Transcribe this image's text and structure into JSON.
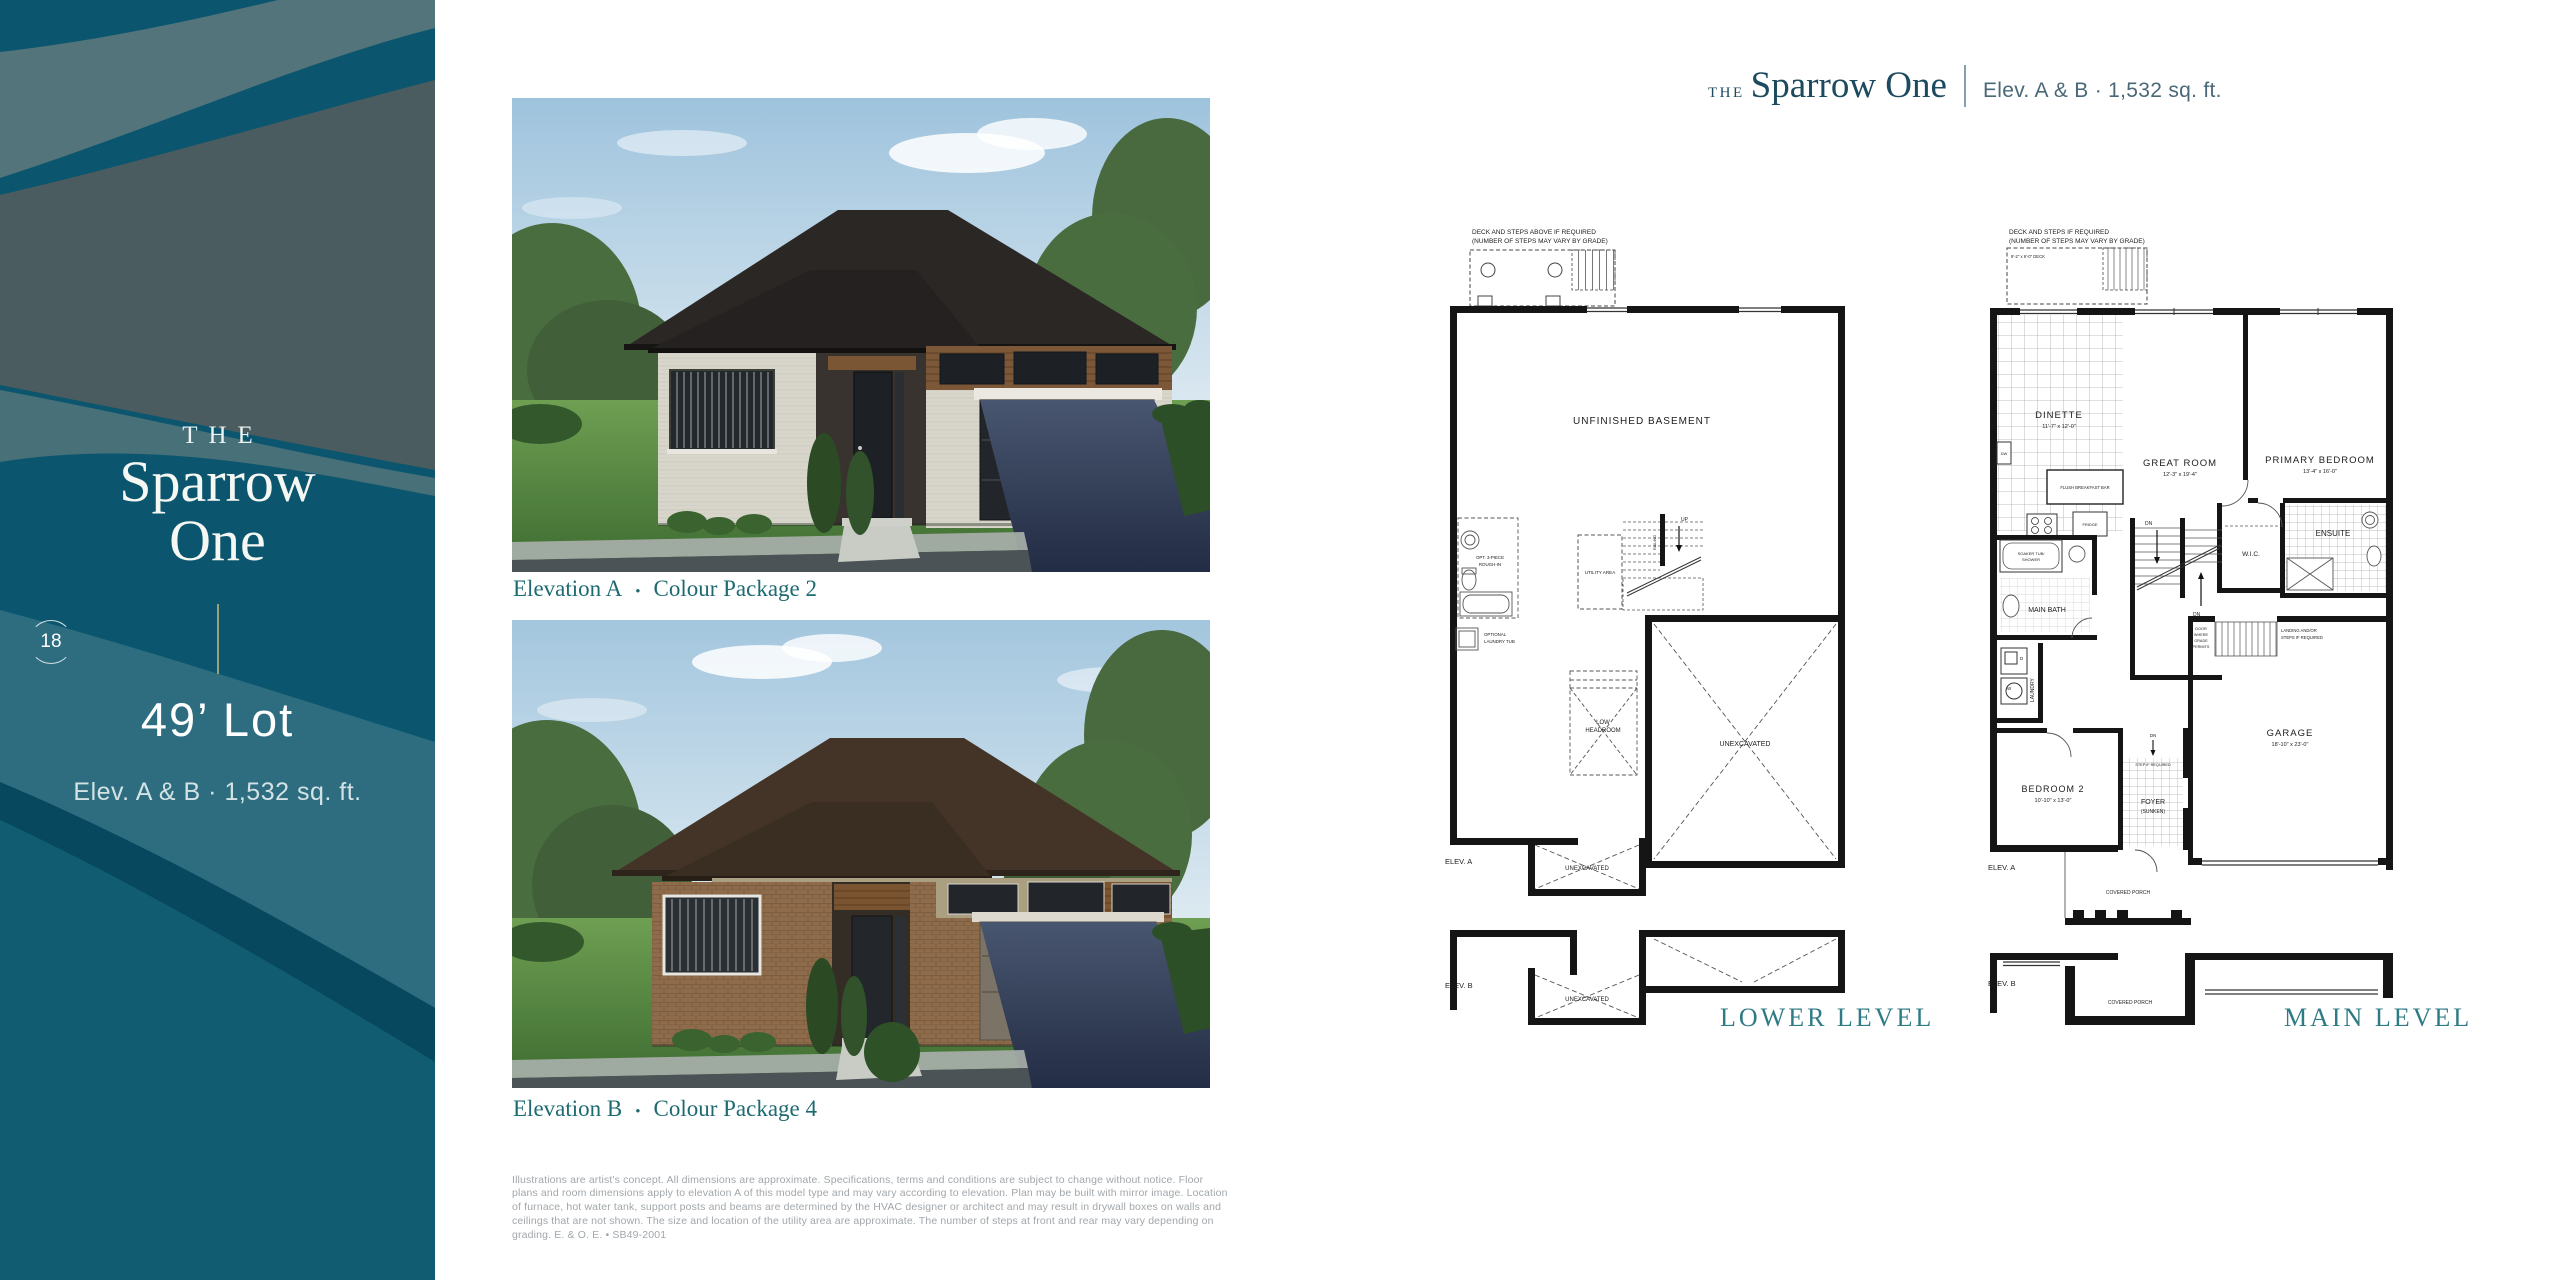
{
  "sidebar": {
    "eyebrow": "THE",
    "model_line1": "Sparrow",
    "model_line2": "One",
    "page_number": "18",
    "lot": "49’ Lot",
    "spec": "Elev. A & B · 1,532 sq. ft."
  },
  "header": {
    "eyebrow": "THE",
    "model_name": "Sparrow One",
    "spec": "Elev. A & B · 1,532 sq. ft."
  },
  "figures": {
    "a": {
      "name": "Elevation A",
      "bullet": "•",
      "package": "Colour Package 2"
    },
    "b": {
      "name": "Elevation B",
      "bullet": "•",
      "package": "Colour Package 4"
    }
  },
  "disclaimer": "Illustrations are artist's concept. All dimensions are approximate. Specifications, terms and conditions are subject to change without notice. Floor plans and room dimensions apply to elevation A of this model type and may vary according to elevation. Plan may be built with mirror image. Location of furnace, hot water tank, support posts and beams are determined by the HVAC designer or architect and may result in drywall boxes on walls and ceilings that are not shown. The size and location of the utility area are approximate. The number of steps at front and rear may vary depending on grading. E. & O. E. • SB49-2001",
  "lower_plan": {
    "title": "LOWER LEVEL",
    "deck_note1": "DECK AND STEPS ABOVE IF REQUIRED",
    "deck_note2": "(NUMBER OF STEPS MAY VARY BY GRADE)",
    "unfinished_basement": "UNFINISHED BASEMENT",
    "rough_in1": "OPT. 3-PIECE",
    "rough_in2": "ROUGH-IN",
    "laundry1": "OPTIONAL",
    "laundry2": "LAUNDRY TUB",
    "utility_area": "UTILITY AREA",
    "up": "UP",
    "railing": "RAILING",
    "low1": "LOW",
    "low2": "HEADROOM",
    "unexcavated": "UNEXCAVATED",
    "elev_a": "ELEV. A",
    "elev_b": "ELEV. B"
  },
  "main_plan": {
    "title": "MAIN LEVEL",
    "deck_note1": "DECK AND STEPS IF REQUIRED",
    "deck_note2": "(NUMBER OF STEPS MAY VARY BY GRADE)",
    "deck_size": "9'-2\" x 6'-0\" DECK",
    "dinette": "DINETTE",
    "dinette_dims": "11'-7\" x 12'-0\"",
    "great_room": "GREAT ROOM",
    "great_room_dims": "12'-3\" x 19'-4\"",
    "primary_bedroom": "PRIMARY BEDROOM",
    "primary_dims": "13'-4\" x 16'-0\"",
    "flush_bar": "FLUSH BREAKFAST BAR",
    "fridge": "FRIDGE",
    "dw": "DW",
    "main_bath": "MAIN BATH",
    "soaker1": "SOAKER TUB/",
    "soaker2": "SHOWER",
    "laundry": "LAUNDRY",
    "washer": "W",
    "dryer": "D",
    "wic": "W.I.C.",
    "ensuite": "ENSUITE",
    "dn": "DN",
    "railing": "RAILING",
    "door_grade1": "DOOR",
    "door_grade2": "WHERE",
    "door_grade3": "GRADE",
    "door_grade4": "PERMITS",
    "landing1": "LANDING AND/OR",
    "landing2": "STEPS IF REQUIRED",
    "bedroom2": "BEDROOM 2",
    "bedroom2_dims": "10'-10\" x 13'-0\"",
    "foyer": "FOYER",
    "foyer_sunken": "(SUNKEN)",
    "step_req": "STEP IF REQUIRED",
    "garage": "GARAGE",
    "garage_dims": "18'-10\" x 23'-0\"",
    "covered_porch": "COVERED PORCH",
    "elev_a": "ELEV. A",
    "elev_b": "ELEV. B"
  },
  "colors": {
    "sidebar_deep_teal": "#0b566e",
    "sidebar_slate": "#4a5c5f",
    "sidebar_gray_band": "#52747a",
    "sidebar_light_band": "#2e6d80",
    "sidebar_navy_stripe": "#07485e",
    "header_navy": "#1c4a5f",
    "caption_teal": "#1d6a71",
    "plan_title_teal": "#2f7b85",
    "divider_tan": "#98a17b"
  }
}
